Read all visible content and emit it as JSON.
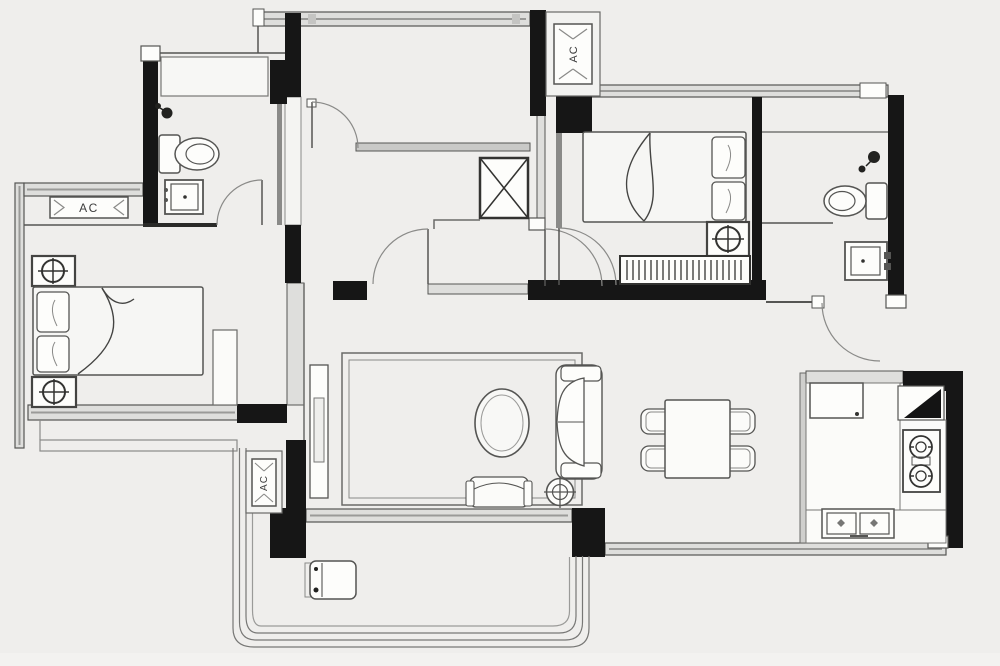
{
  "floorplan": {
    "background_color": "#efeeec",
    "wall_color": "#161616",
    "thin_line_color": "#4f4f4f",
    "window_fill_color": "#dededc",
    "labels": {
      "ac_unit_left": "AC",
      "ac_unit_top": "AC",
      "ac_unit_balcony": "AC"
    },
    "icon_names": [
      "toilet-icon",
      "sink-icon",
      "shower-head-icon",
      "bed-icon",
      "pillow-icon",
      "nightstand-lamp-icon",
      "dresser-hatch-icon",
      "shaft-x-icon",
      "door-arc-icon",
      "window-band-icon",
      "sofa-icon",
      "coffee-table-icon",
      "bench-icon",
      "floor-lamp-icon",
      "tv-console-icon",
      "dining-table-icon",
      "dining-chair-icon",
      "fridge-icon",
      "corner-cabinet-icon",
      "stove-icon",
      "kitchen-sink-icon",
      "washing-machine-icon",
      "balcony-railing-icon",
      "ac-unit-icon"
    ]
  }
}
